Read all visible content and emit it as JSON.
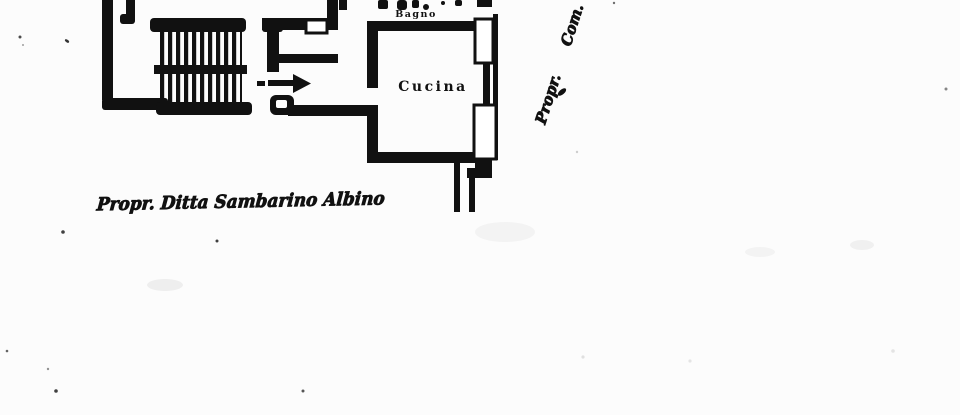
{
  "plan": {
    "rooms": [
      {
        "label": "Bagno"
      },
      {
        "label": "Cucina"
      }
    ],
    "annotations": {
      "owner_note": "Propr. Ditta Sambarino Albino",
      "side_note_word1": "Propr.",
      "side_note_word2": "Com."
    },
    "icons": {
      "entry_arrow": "right-arrow",
      "staircase": "hatched-stair-treads"
    },
    "colors": {
      "ink": "#161616",
      "paper": "#fcfcfc"
    }
  }
}
